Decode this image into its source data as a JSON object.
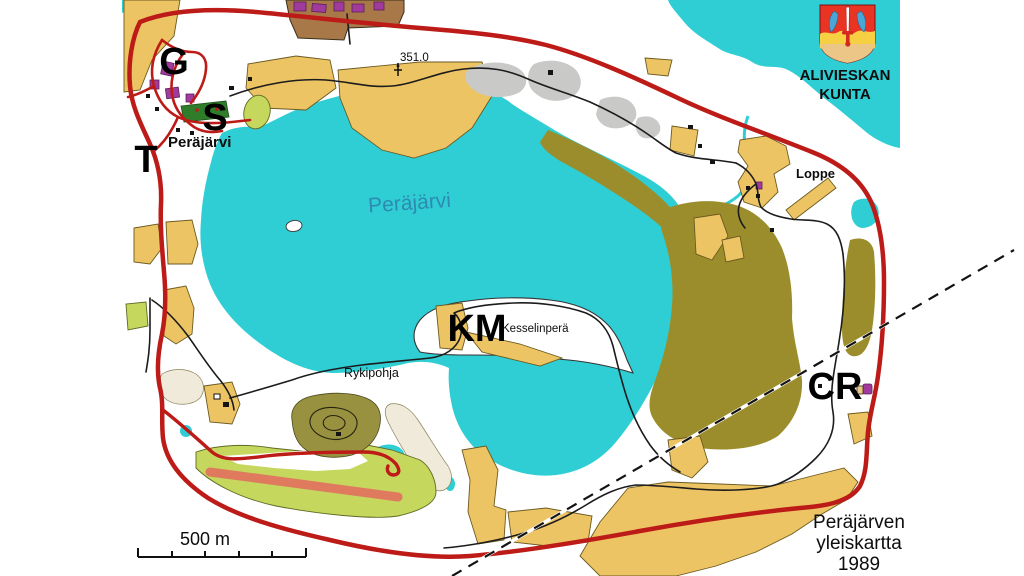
{
  "map": {
    "municipality": {
      "line1": "ALIVIESKAN",
      "line2": "KUNTA"
    },
    "title_block": {
      "line1": "Peräjärven",
      "line2": "yleiskartta",
      "line3": "1989"
    },
    "scale": {
      "label": "500 m"
    },
    "labels": {
      "lake": "Peräjärvi",
      "village": "Peräjärvi",
      "kesselinpera": "Kesselinperä",
      "rykipohja": "Rykipohja",
      "loppe": "Loppe",
      "elevation": "351.0"
    },
    "markers": {
      "g": "G",
      "s": "S",
      "t": "T",
      "km": "KM",
      "cr": "CR"
    },
    "colors": {
      "water": "#2fced5",
      "water_label": "#2e8bb0",
      "field": "#edc464",
      "field_stroke": "#6b5a20",
      "marsh": "#9c8d2c",
      "grass": "#c6d75e",
      "forest_hill": "#98913f",
      "sports_green": "#2f7d2a",
      "runway": "#df7a5f",
      "road_red": "#bc1b17",
      "road_black": "#1c1c1c",
      "building_purple": "#a03a9c",
      "building_brown": "#a87848",
      "gray": "#c9c9c7",
      "bog": "#efead9",
      "shield_red": "#e93323",
      "shield_yellow": "#f6d042",
      "shield_tan": "#ecc687",
      "fish_blue": "#4aa6d6"
    }
  }
}
